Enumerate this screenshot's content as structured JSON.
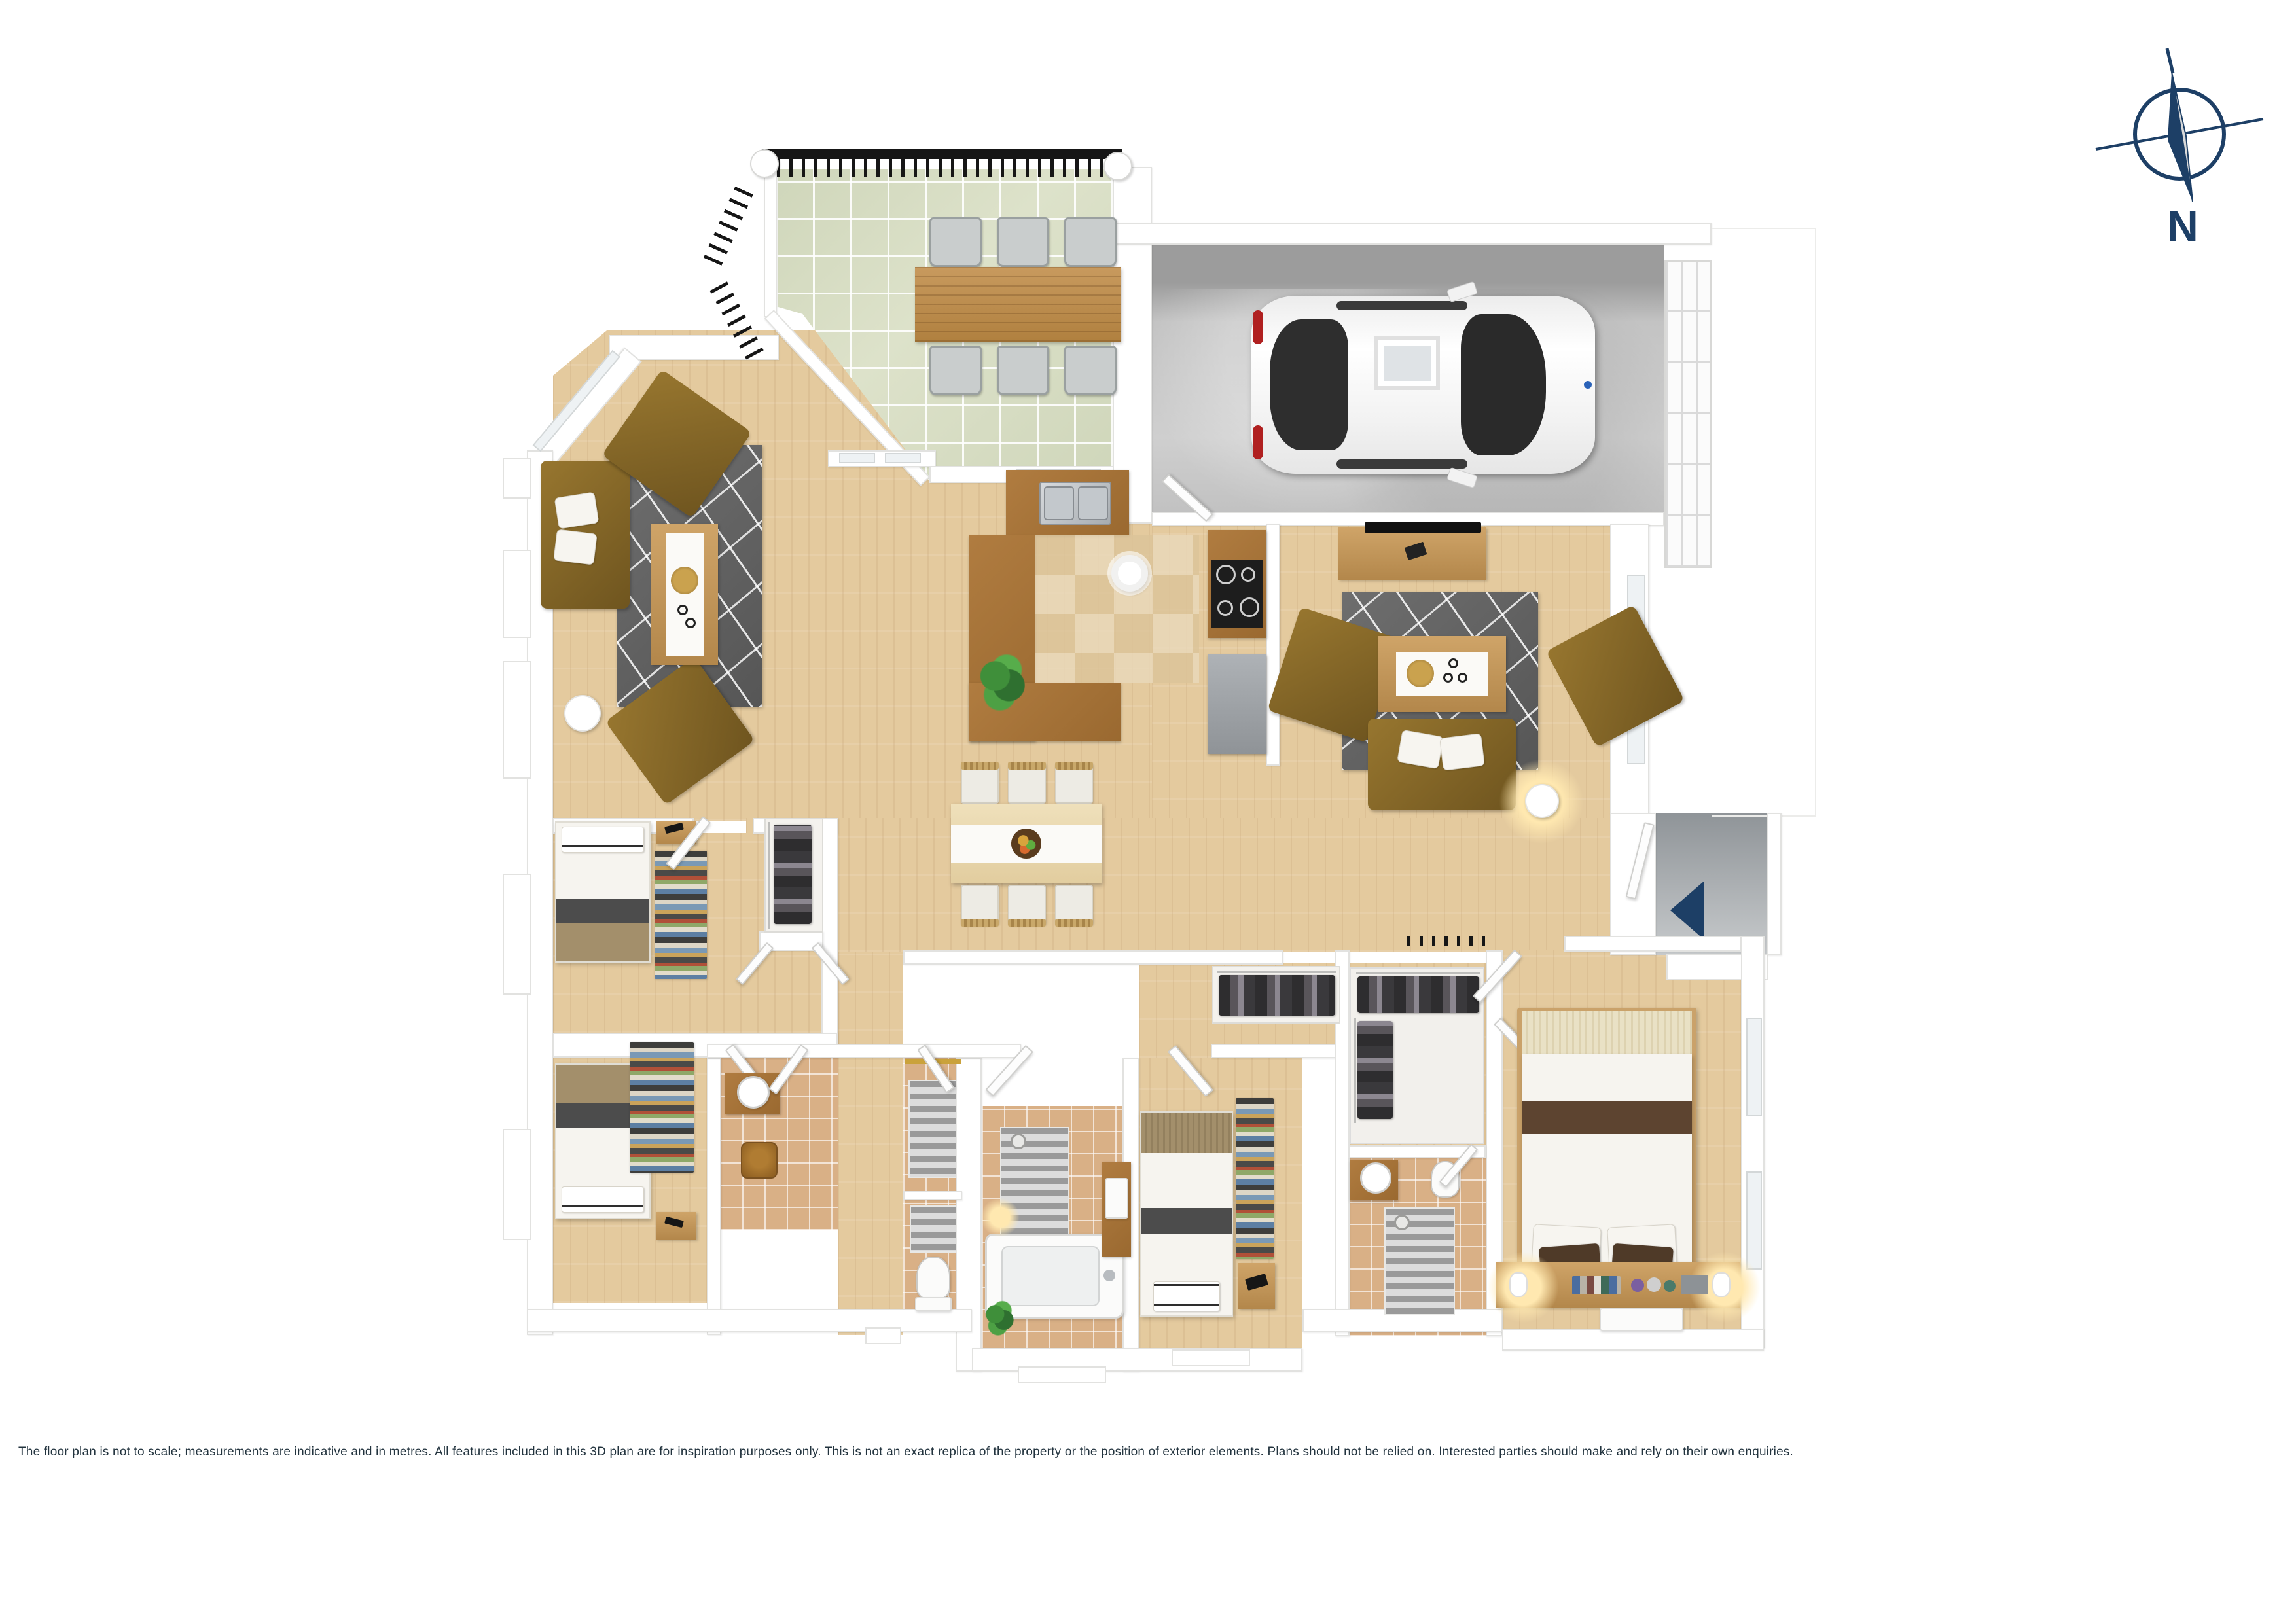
{
  "compass": {
    "label": "N"
  },
  "footer": {
    "disclaimer": "The floor plan is not to scale; measurements are indicative and in metres. All features included in this 3D plan are for inspiration purposes only. This is not an exact replica of the property or the position of exterior elements. Plans should not be relied on. Interested parties should make and rely on their own enquiries."
  },
  "palette": {
    "navy": "#1d3f66",
    "textnavy": "#22333e",
    "wood": "#e4ca9e",
    "sage": "#cfd6ba",
    "garage": "#c3c3c3",
    "walledge": "#e2e2e0",
    "tantile": "#d9b086",
    "rug_gray": "#636363",
    "olive": "#8a6a2e",
    "timber": "#c89a5e",
    "counter_brown": "#a8743a",
    "linen": "#f6f4ef",
    "dark_band": "#4c4c4c",
    "tan_band": "#a38f6b",
    "master_brown": "#5d4430",
    "headboard_cream": "#e9e1c5",
    "steel_gray": "#b9bdc1"
  }
}
